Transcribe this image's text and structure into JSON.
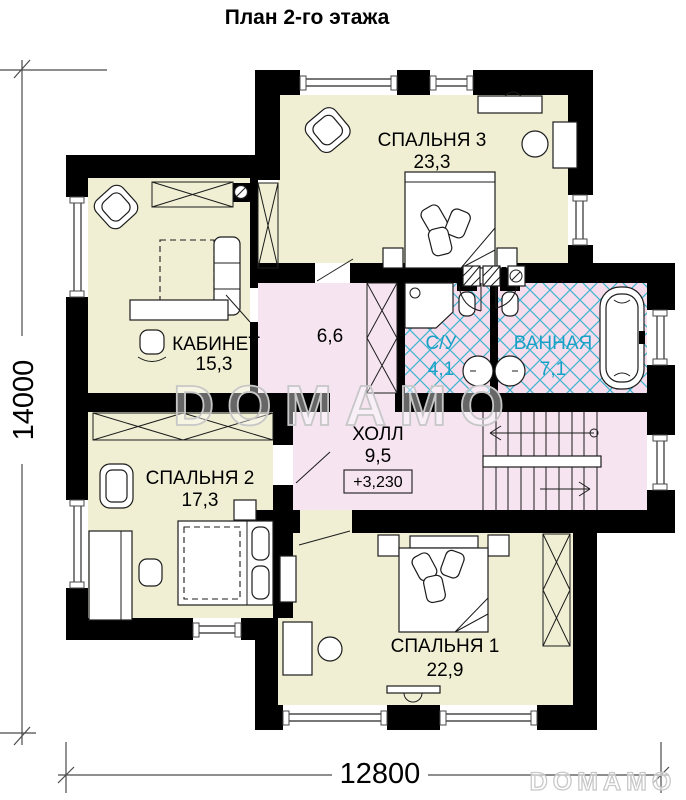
{
  "title": "План 2-го этажа",
  "rooms": {
    "bedroom3": {
      "label": "СПАЛЬНЯ 3",
      "area": "23,3"
    },
    "office": {
      "label": "КАБИНЕТ",
      "area": "15,3"
    },
    "bedroom2": {
      "label": "СПАЛЬНЯ 2",
      "area": "17,3"
    },
    "bedroom1": {
      "label": "СПАЛЬНЯ 1",
      "area": "22,9"
    },
    "hall": {
      "label": "ХОЛЛ",
      "area": "9,5"
    },
    "wc": {
      "label": "С/У",
      "area": "4,1"
    },
    "bathroom": {
      "label": "ВАННАЯ",
      "area": "7,1"
    },
    "corridor": {
      "area": "6,6"
    }
  },
  "elevation_mark": "+3,230",
  "dimensions": {
    "horizontal": "12800",
    "vertical": "14000"
  },
  "watermark": {
    "center": "DOMAMO",
    "corner": "DOMAMO"
  },
  "colors": {
    "room_fill": "#f0efd3",
    "hall_fill": "#f6e4f1",
    "bath_fill": "#f5dded",
    "tile_line": "#3cb4cf",
    "bath_text": "#17a1c6",
    "wall": "#000000",
    "watermark": "#c7c7c7"
  }
}
